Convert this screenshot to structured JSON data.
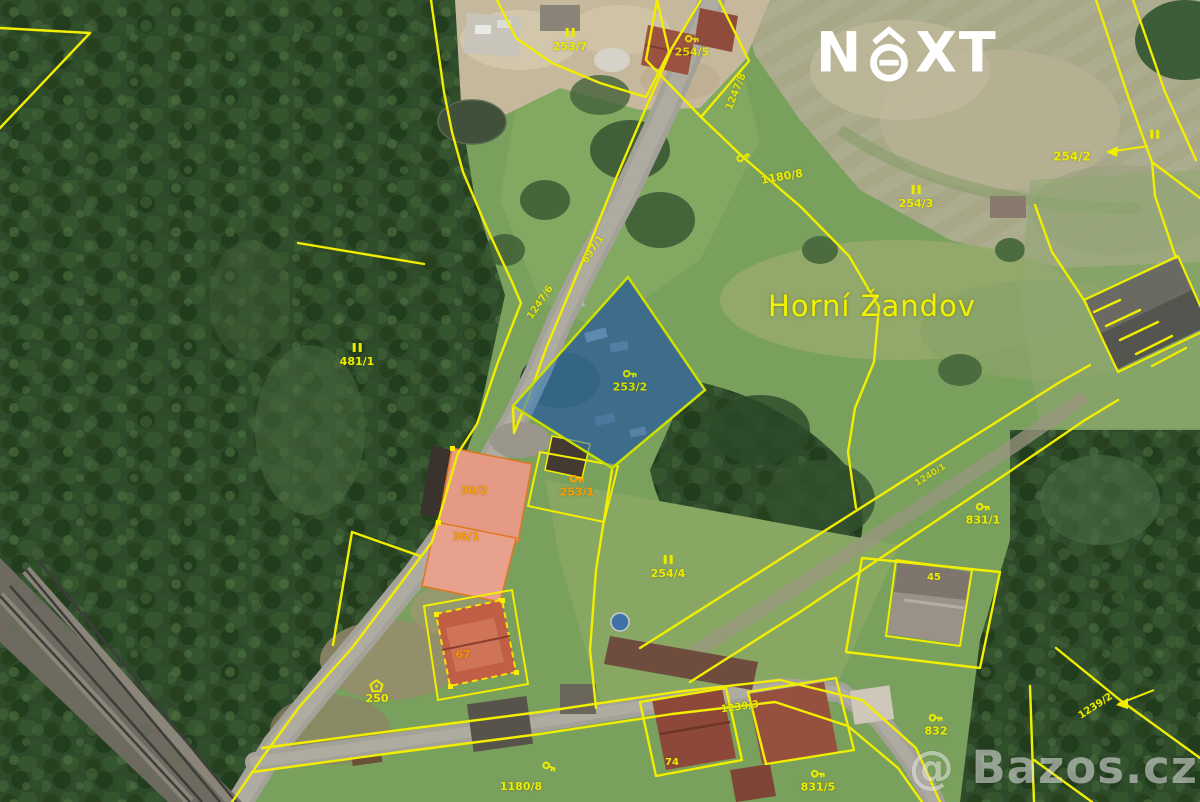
{
  "branding": {
    "logo_pre": "N",
    "logo_post": "XT",
    "watermark": "@ Bazos.cz",
    "logo_color": "#ffffff"
  },
  "map": {
    "place_name": "Horní Žandov",
    "highlighted_parcel": {
      "number": "253/2"
    },
    "colors": {
      "parcel_line": "#f2ee00",
      "label_yellow": "#ecec00",
      "label_orange": "#ff9d00",
      "highlight_parcel_fill": "rgba(58,125,180,0.62)",
      "highlight_parcel_border": "#cde000",
      "building_highlight_fill": "#e59a86",
      "building_highlight_stroke": "#e07820"
    },
    "labels": [
      {
        "icon": "bars",
        "text": "253/7",
        "x": 570,
        "y": 40
      },
      {
        "icon": "key",
        "text": "254/5",
        "x": 692,
        "y": 46,
        "opacity": 0.85
      },
      {
        "text": "1247/8",
        "x": 737,
        "y": 92,
        "rot": -68,
        "size": 10,
        "opacity": 0.9
      },
      {
        "icon": "key",
        "x": 744,
        "y": 158,
        "rot": -30
      },
      {
        "text": "1180/8",
        "x": 782,
        "y": 177,
        "rot": -10
      },
      {
        "text": "697/1",
        "x": 594,
        "y": 250,
        "rot": -56,
        "size": 10,
        "opacity": 0.9
      },
      {
        "text": "1247/6",
        "x": 541,
        "y": 303,
        "rot": -56,
        "size": 10,
        "opacity": 0.9
      },
      {
        "icon": "bars",
        "text": "254/3",
        "x": 916,
        "y": 197
      },
      {
        "text": "254/2",
        "x": 1072,
        "y": 157,
        "size": 12
      },
      {
        "icon": "bars",
        "x": 1155,
        "y": 136
      },
      {
        "name": "place-label",
        "text": "Horní Žandov",
        "x": 872,
        "y": 306,
        "size": 29,
        "weight": 400,
        "color": "#f2f200"
      },
      {
        "icon": "bars",
        "text": "481/1",
        "x": 357,
        "y": 355
      },
      {
        "icon": "key",
        "text": "253/2",
        "x": 630,
        "y": 381,
        "color": "#cfdf00"
      },
      {
        "text": "36/2",
        "x": 474,
        "y": 491,
        "color": "#ff9d00"
      },
      {
        "icon": "key",
        "text": "253/1",
        "x": 577,
        "y": 486,
        "color": "#ff9d00"
      },
      {
        "text": "36/1",
        "x": 466,
        "y": 537,
        "color": "#ff9d00"
      },
      {
        "icon": "bars",
        "text": "254/4",
        "x": 668,
        "y": 567
      },
      {
        "text": "1240/1",
        "x": 931,
        "y": 476,
        "rot": -32,
        "size": 9,
        "opacity": 0.8
      },
      {
        "icon": "key",
        "text": "831/1",
        "x": 983,
        "y": 514
      },
      {
        "text": "45",
        "x": 934,
        "y": 578,
        "size": 10
      },
      {
        "text": "67",
        "x": 463,
        "y": 655,
        "color": "#ff8c00"
      },
      {
        "icon": "house",
        "text": "250",
        "x": 377,
        "y": 692
      },
      {
        "text": "1239/3",
        "x": 740,
        "y": 708,
        "rot": -8,
        "size": 10
      },
      {
        "icon": "key",
        "text": "832",
        "x": 936,
        "y": 725
      },
      {
        "text": "1239/2",
        "x": 1096,
        "y": 707,
        "rot": -33,
        "size": 10
      },
      {
        "text": "74",
        "x": 672,
        "y": 763,
        "size": 10
      },
      {
        "icon": "key",
        "text": "831/5",
        "x": 818,
        "y": 781
      },
      {
        "icon": "key",
        "x": 549,
        "y": 768,
        "rot": 20
      },
      {
        "text": "1180/8",
        "x": 521,
        "y": 787
      }
    ]
  }
}
